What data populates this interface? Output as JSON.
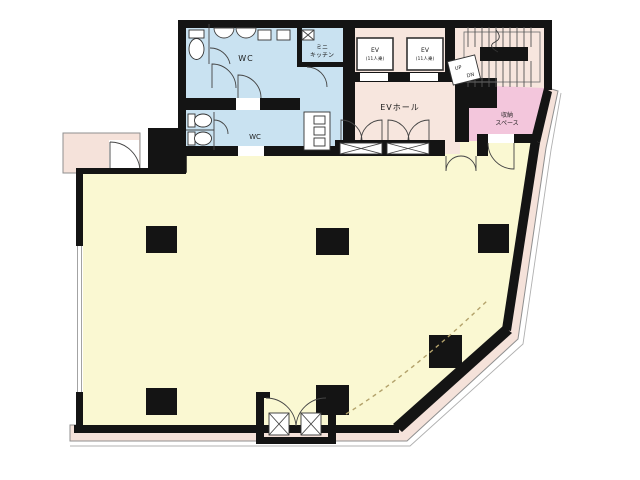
{
  "colors": {
    "background": "#ffffff",
    "wall": "#141414",
    "main_floor": "#FAF8D2",
    "wet_area": "#C9E2F1",
    "service_area": "#F7E6DE",
    "storage_area": "#F3C6DC",
    "balcony": "#F5E2DA",
    "dashed_line": "#B3A26B"
  },
  "rooms": {
    "wc_upper": {
      "label": "WC"
    },
    "wc_lower": {
      "label": "WC"
    },
    "mini_kitchen": {
      "line1": "ミニ",
      "line2": "キッチン"
    },
    "elevator_1": {
      "line1": "EV",
      "line2": "(11人乗)"
    },
    "elevator_2": {
      "line1": "EV",
      "line2": "(11人乗)"
    },
    "ev_hall": {
      "label": "EVホール"
    },
    "stairs": {
      "up": "UP",
      "dn": "DN"
    },
    "storage": {
      "line1": "収納",
      "line2": "スペース"
    }
  }
}
